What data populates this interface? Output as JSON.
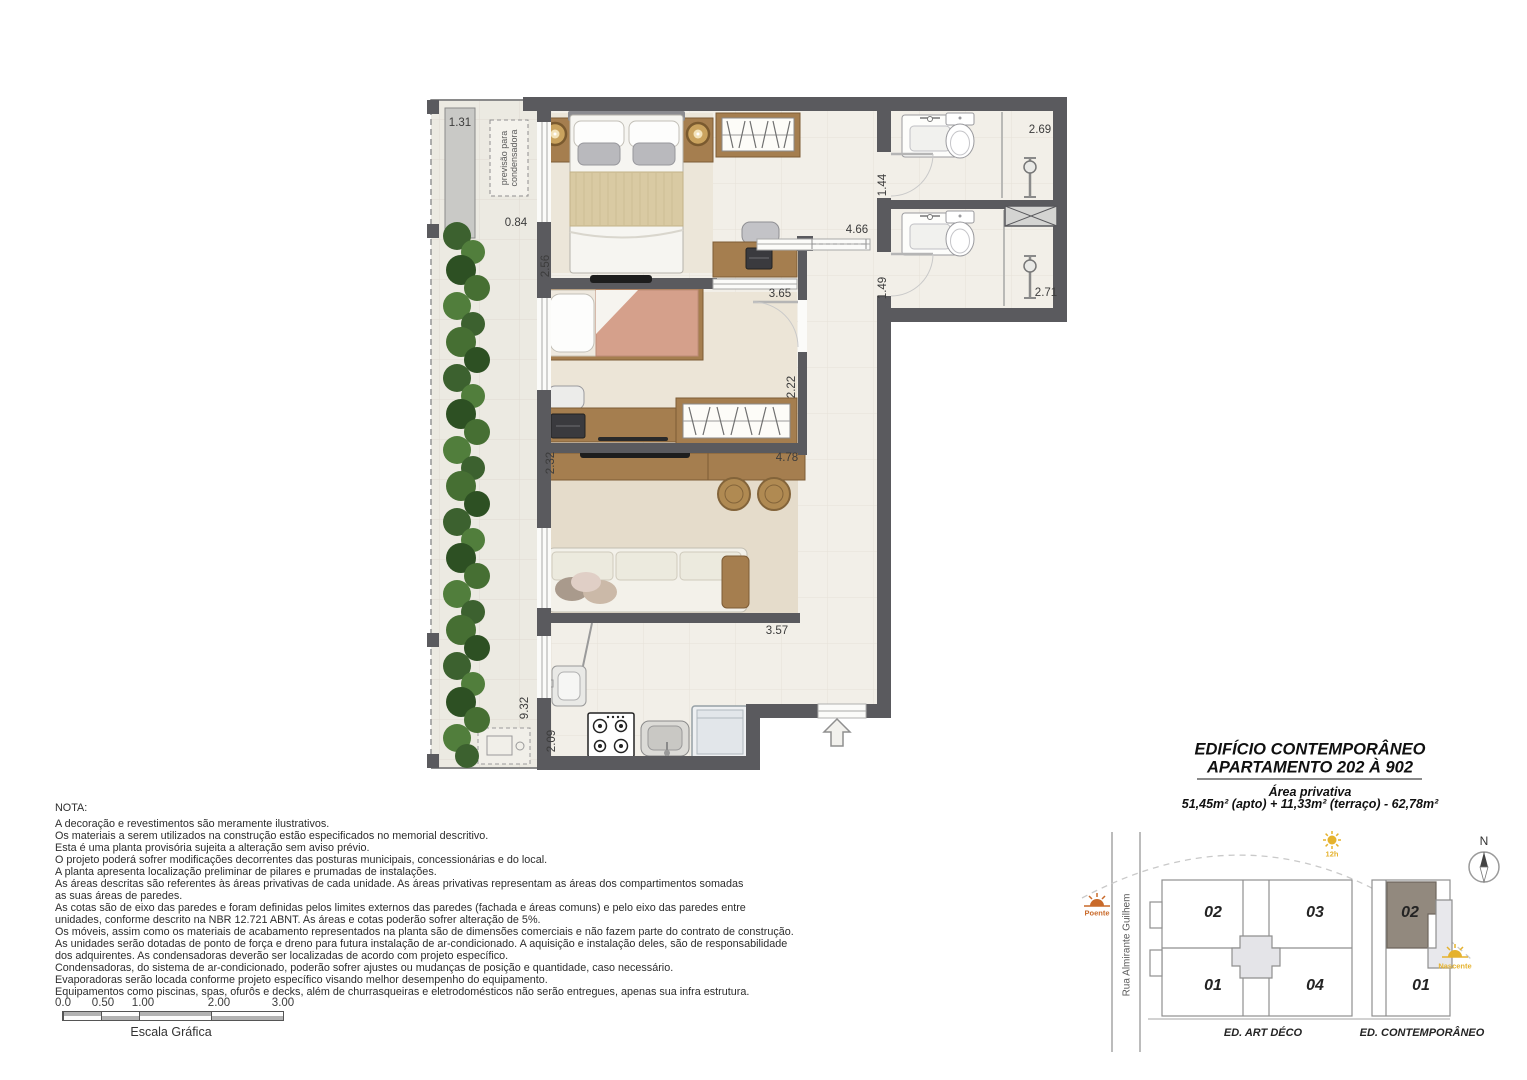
{
  "plan": {
    "condenser_label": "previsão para condensadora",
    "dimensions": {
      "d131": "1.31",
      "d084": "0.84",
      "d256": "2.56",
      "d365": "3.65",
      "d466": "4.66",
      "d144": "1.44",
      "d269": "2.69",
      "d149": "1.49",
      "d271": "2.71",
      "d222": "2.22",
      "d232": "2.32",
      "d478": "4.78",
      "d357": "3.57",
      "d932": "9.32",
      "d209": "2.09"
    }
  },
  "nota": {
    "heading": "NOTA:",
    "lines": [
      "A decoração e revestimentos são meramente ilustrativos.",
      "Os materiais a serem utilizados na construção estão especificados no memorial descritivo.",
      "Esta é uma planta provisória sujeita a alteração sem aviso prévio.",
      "O projeto poderá sofrer modificações decorrentes das posturas municipais, concessionárias e do local.",
      "A planta apresenta localização preliminar de pilares e prumadas de instalações.",
      "As áreas descritas são referentes às áreas privativas de cada unidade. As áreas privativas representam as áreas dos compartimentos somadas",
      "as suas áreas de paredes.",
      "As cotas são de eixo das paredes e foram definidas pelos limites externos das paredes (fachada e áreas comuns) e pelo eixo das paredes entre",
      "unidades, conforme descrito na NBR 12.721 ABNT. As áreas e cotas poderão sofrer alteração de 5%.",
      "Os móveis, assim como os materiais de acabamento representados na planta são de dimensões comerciais e não fazem parte do contrato de construção.",
      "As unidades serão dotadas de ponto de força e dreno para futura instalação de ar-condicionado. A aquisição e instalação deles, são de responsabilidade",
      "dos adquirentes. As condensadoras deverão ser localizadas de acordo com projeto específico.",
      "Condensadoras, do sistema de ar-condicionado, poderão sofrer ajustes ou mudanças de posição e quantidade, caso necessário.",
      "Evaporadoras serão locada conforme projeto específico visando melhor desempenho do equipamento.",
      "Equipamentos como piscinas, spas, ofurôs e decks, além de churrasqueiras e eletrodomésticos não serão entregues, apenas sua infra estrutura."
    ]
  },
  "scale": {
    "ticks": [
      "0.0",
      "0.50",
      "1.00",
      "2.00",
      "3.00"
    ],
    "label": "Escala Gráfica"
  },
  "title_block": {
    "line1": "EDIFÍCIO CONTEMPORÂNEO",
    "line2": "APARTAMENTO 202 À 902",
    "area_label": "Área privativa",
    "area_value": "51,45m² (apto) + 11,33m² (terraço) - 62,78m²"
  },
  "site_plan": {
    "street": "Rua Almirante Guilhem",
    "building_left": {
      "label": "ED. ART DÉCO",
      "units": [
        "02",
        "03",
        "01",
        "04"
      ]
    },
    "building_right": {
      "label": "ED. CONTEMPORÂNEO",
      "units": [
        "02",
        "01"
      ]
    },
    "north_label": "N",
    "sun_west": "Poente",
    "sun_noon": "12h",
    "sun_east": "Nascente"
  },
  "colors": {
    "wall": "#5a5a5e",
    "wood": "#a57e4f",
    "floor": "#f2efe8",
    "hedge_green": "#46702f",
    "highlight_unit": "#92897e",
    "sun_yellow": "#e5b22e",
    "sun_orange": "#c96a2a"
  }
}
